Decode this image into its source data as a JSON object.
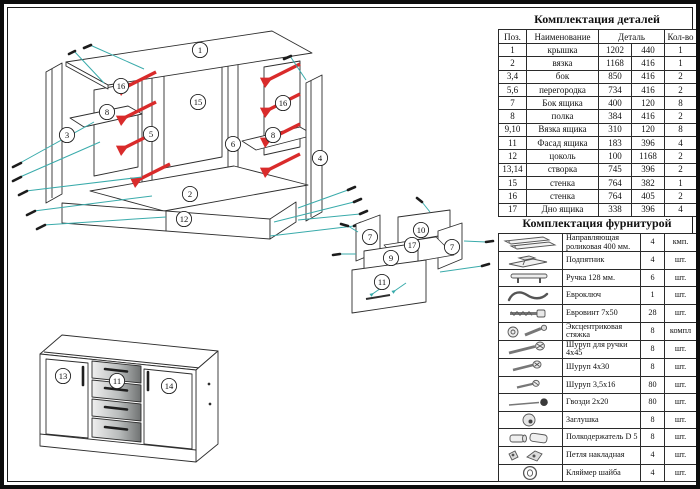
{
  "doc": {
    "parts_title": "Комплектация деталей",
    "hardware_title": "Комплектация фурнитурой"
  },
  "parts_table": {
    "headers": {
      "pos": "Поз.",
      "name": "Наименование",
      "detail": "Деталь",
      "qty": "Кол-во"
    },
    "rows": [
      {
        "pos": "1",
        "name": "крышка",
        "d1": "1202",
        "d2": "440",
        "qty": "1"
      },
      {
        "pos": "2",
        "name": "вязка",
        "d1": "1168",
        "d2": "416",
        "qty": "1"
      },
      {
        "pos": "3,4",
        "name": "бок",
        "d1": "850",
        "d2": "416",
        "qty": "2"
      },
      {
        "pos": "5,6",
        "name": "перегородка",
        "d1": "734",
        "d2": "416",
        "qty": "2"
      },
      {
        "pos": "7",
        "name": "Бок ящика",
        "d1": "400",
        "d2": "120",
        "qty": "8"
      },
      {
        "pos": "8",
        "name": "полка",
        "d1": "384",
        "d2": "416",
        "qty": "2"
      },
      {
        "pos": "9,10",
        "name": "Вязка ящика",
        "d1": "310",
        "d2": "120",
        "qty": "8"
      },
      {
        "pos": "11",
        "name": "Фасад ящика",
        "d1": "183",
        "d2": "396",
        "qty": "4"
      },
      {
        "pos": "12",
        "name": "цоколь",
        "d1": "100",
        "d2": "1168",
        "qty": "2"
      },
      {
        "pos": "13,14",
        "name": "створка",
        "d1": "745",
        "d2": "396",
        "qty": "2"
      },
      {
        "pos": "15",
        "name": "стенка",
        "d1": "764",
        "d2": "382",
        "qty": "1"
      },
      {
        "pos": "16",
        "name": "стенка",
        "d1": "764",
        "d2": "405",
        "qty": "2"
      },
      {
        "pos": "17",
        "name": "Дно ящика",
        "d1": "338",
        "d2": "396",
        "qty": "4"
      }
    ]
  },
  "hardware_table": {
    "rows": [
      {
        "icon": "roller-guide-icon",
        "name": "Направляющая роликовая 400 мм.",
        "qty": "4",
        "unit": "кмп."
      },
      {
        "icon": "foot-icon",
        "name": "Подпятник",
        "qty": "4",
        "unit": "шт."
      },
      {
        "icon": "handle-icon",
        "name": "Ручка 128 мм.",
        "qty": "6",
        "unit": "шт."
      },
      {
        "icon": "hex-key-icon",
        "name": "Евроключ",
        "qty": "1",
        "unit": "шт."
      },
      {
        "icon": "confirmat-icon",
        "name": "Евровинт 7x50",
        "qty": "28",
        "unit": "шт."
      },
      {
        "icon": "cam-lock-icon",
        "name": "Эксцентриковая стяжка",
        "qty": "8",
        "unit": "компл"
      },
      {
        "icon": "screw-large-icon",
        "name": "Шуруп для ручки 4x45",
        "qty": "8",
        "unit": "шт."
      },
      {
        "icon": "screw-medium-icon",
        "name": "Шуруп 4x30",
        "qty": "8",
        "unit": "шт."
      },
      {
        "icon": "screw-small-icon",
        "name": "Шуруп 3,5x16",
        "qty": "80",
        "unit": "шт."
      },
      {
        "icon": "nail-icon",
        "name": "Гвозди 2x20",
        "qty": "80",
        "unit": "шт."
      },
      {
        "icon": "cap-icon",
        "name": "Заглушка",
        "qty": "8",
        "unit": "шт."
      },
      {
        "icon": "shelf-pin-icon",
        "name": "Полкодержатель D 5",
        "qty": "8",
        "unit": "шт."
      },
      {
        "icon": "hinge-icon",
        "name": "Петля накладная",
        "qty": "4",
        "unit": "шт."
      },
      {
        "icon": "washer-icon",
        "name": "Кляймер шайба",
        "qty": "4",
        "unit": "шт."
      }
    ]
  },
  "diagram": {
    "colors": {
      "slide_red": "#d92b2b",
      "leader_cyan": "#3aabab",
      "line": "#2e2e2e"
    },
    "callouts": [
      {
        "n": "1",
        "x": 196,
        "y": 46
      },
      {
        "n": "3",
        "x": 63,
        "y": 131
      },
      {
        "n": "16",
        "x": 117,
        "y": 82
      },
      {
        "n": "8",
        "x": 103,
        "y": 108
      },
      {
        "n": "5",
        "x": 147,
        "y": 130
      },
      {
        "n": "15",
        "x": 194,
        "y": 98
      },
      {
        "n": "6",
        "x": 229,
        "y": 140
      },
      {
        "n": "16",
        "x": 279,
        "y": 99
      },
      {
        "n": "8",
        "x": 269,
        "y": 131
      },
      {
        "n": "4",
        "x": 316,
        "y": 154
      },
      {
        "n": "2",
        "x": 186,
        "y": 190
      },
      {
        "n": "12",
        "x": 180,
        "y": 215
      },
      {
        "n": "7",
        "x": 366,
        "y": 233
      },
      {
        "n": "10",
        "x": 417,
        "y": 226
      },
      {
        "n": "17",
        "x": 408,
        "y": 241
      },
      {
        "n": "7",
        "x": 448,
        "y": 243
      },
      {
        "n": "9",
        "x": 387,
        "y": 254
      },
      {
        "n": "11",
        "x": 378,
        "y": 278
      },
      {
        "n": "13",
        "x": 59,
        "y": 372
      },
      {
        "n": "11",
        "x": 113,
        "y": 377
      },
      {
        "n": "14",
        "x": 165,
        "y": 382
      }
    ]
  }
}
